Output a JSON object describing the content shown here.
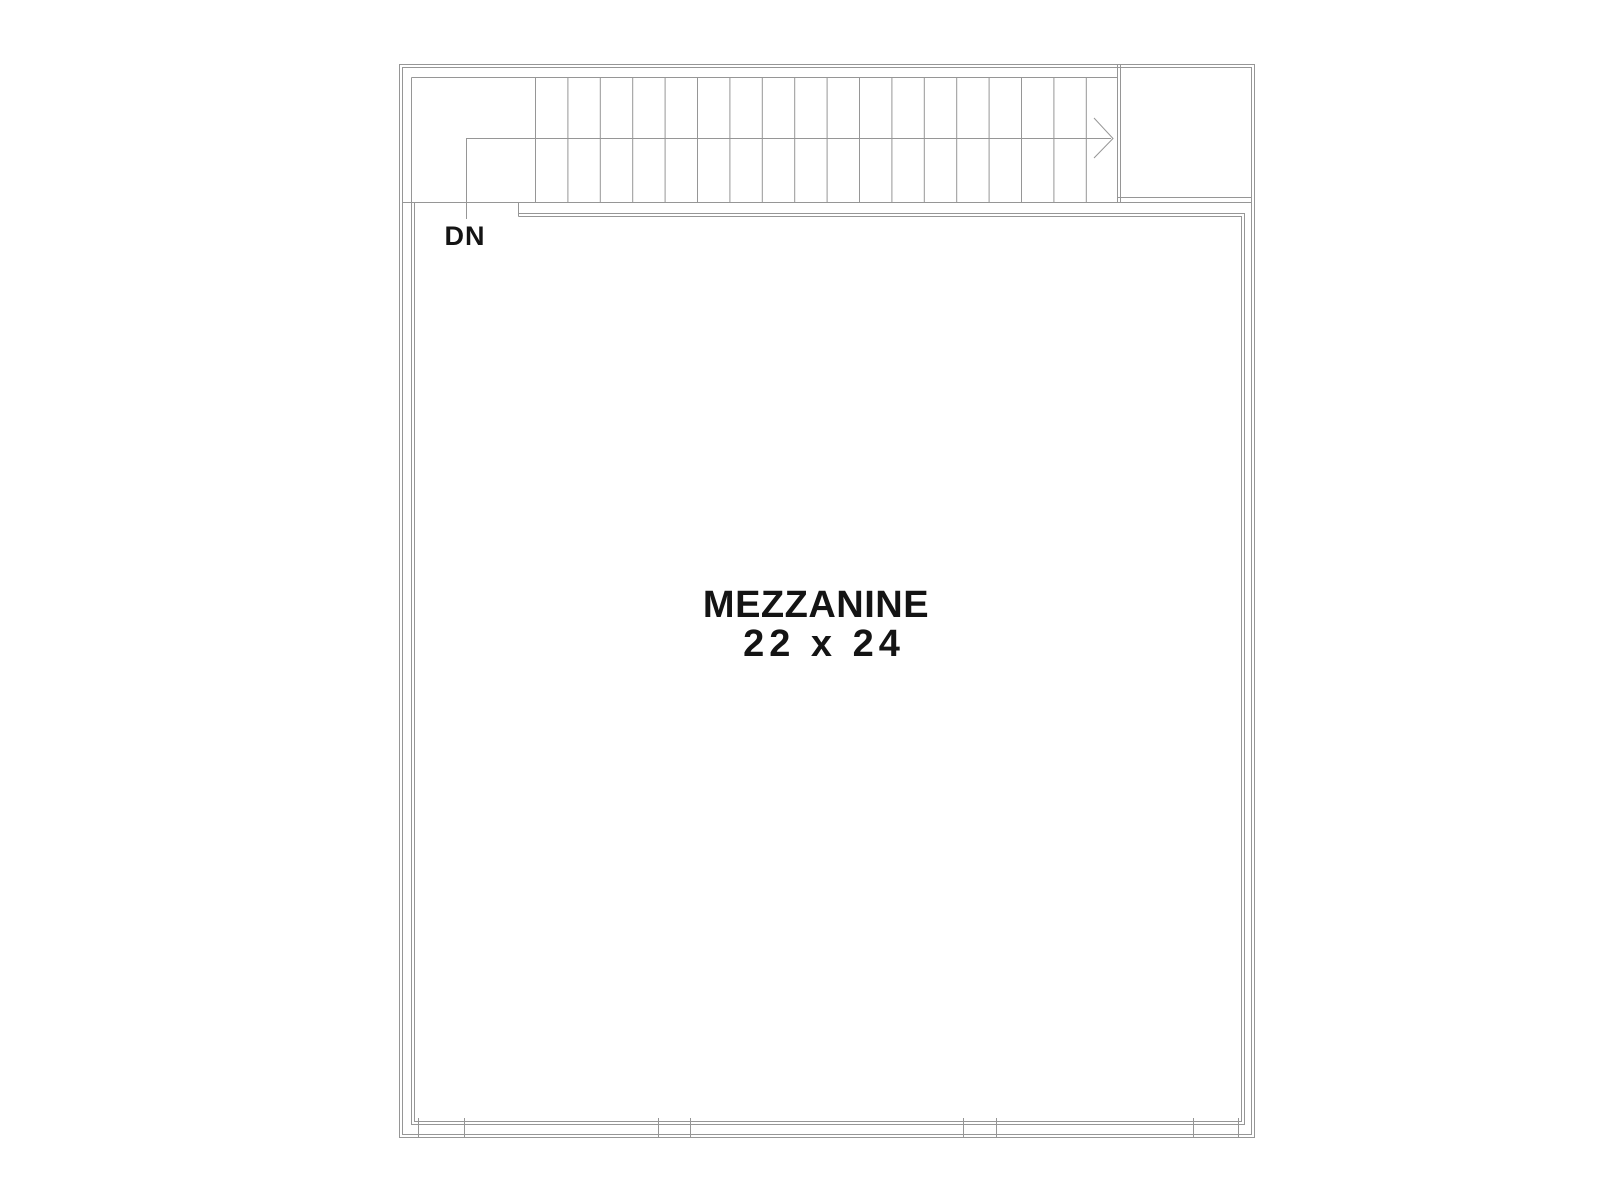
{
  "title": "Mezzanine floor plan",
  "labels": {
    "stair_direction": "DN",
    "room_name": "MEZZANINE",
    "room_size": "22 x 24"
  },
  "stairs": {
    "tread_count": 18
  },
  "colors": {
    "background": "#ffffff",
    "line": "#969696",
    "text": "#141414"
  }
}
